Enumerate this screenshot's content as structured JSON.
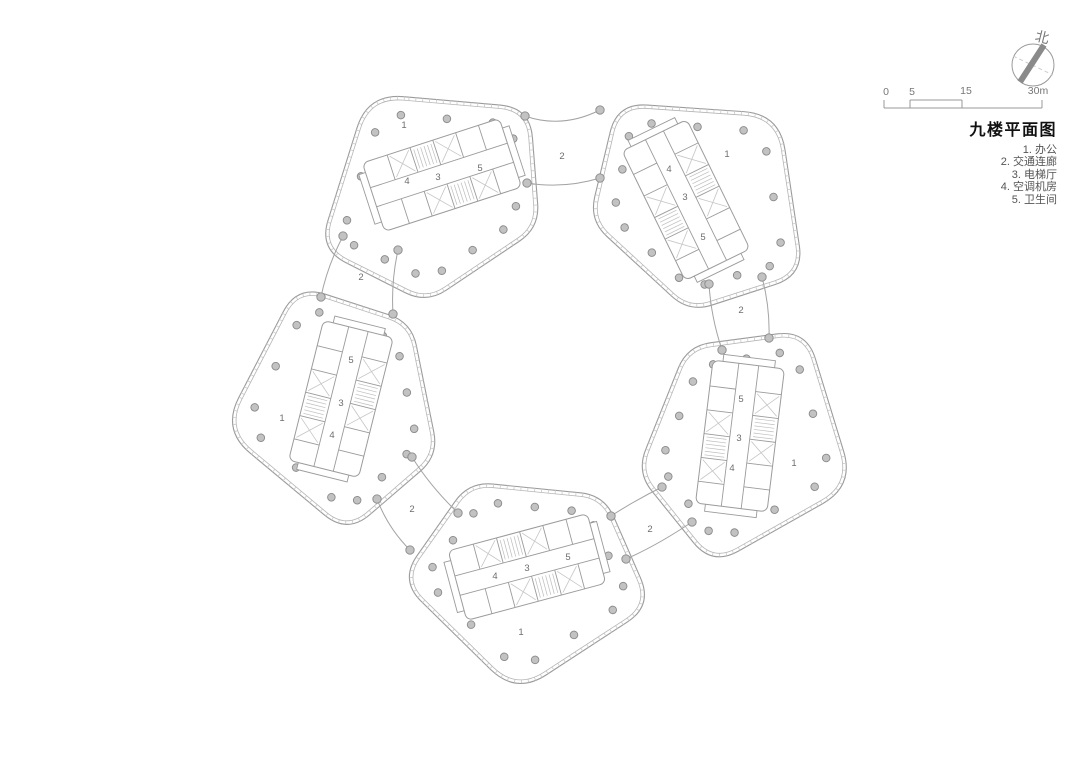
{
  "title_block": {
    "title": "九楼平面图",
    "legend": [
      "1. 办公",
      "2. 交通连廊",
      "3. 电梯厅",
      "4. 空调机房",
      "5. 卫生间"
    ]
  },
  "north_indicator": {
    "label": "北"
  },
  "scale_bar": {
    "ticks": [
      "0",
      "5",
      "15",
      "30m"
    ]
  },
  "plan": {
    "floor_labels": [
      {
        "t": "1",
        "x": 404,
        "y": 125
      },
      {
        "t": "1",
        "x": 727,
        "y": 154
      },
      {
        "t": "1",
        "x": 282,
        "y": 418
      },
      {
        "t": "1",
        "x": 794,
        "y": 463
      },
      {
        "t": "1",
        "x": 521,
        "y": 632
      },
      {
        "t": "2",
        "x": 562,
        "y": 156
      },
      {
        "t": "2",
        "x": 361,
        "y": 277
      },
      {
        "t": "2",
        "x": 741,
        "y": 310
      },
      {
        "t": "2",
        "x": 412,
        "y": 509
      },
      {
        "t": "2",
        "x": 650,
        "y": 529
      },
      {
        "t": "3",
        "x": 438,
        "y": 177
      },
      {
        "t": "3",
        "x": 685,
        "y": 197
      },
      {
        "t": "3",
        "x": 341,
        "y": 403
      },
      {
        "t": "3",
        "x": 739,
        "y": 438
      },
      {
        "t": "3",
        "x": 527,
        "y": 568
      },
      {
        "t": "4",
        "x": 407,
        "y": 181
      },
      {
        "t": "4",
        "x": 669,
        "y": 169
      },
      {
        "t": "4",
        "x": 332,
        "y": 435
      },
      {
        "t": "4",
        "x": 732,
        "y": 468
      },
      {
        "t": "4",
        "x": 495,
        "y": 576
      },
      {
        "t": "5",
        "x": 480,
        "y": 168
      },
      {
        "t": "5",
        "x": 703,
        "y": 237
      },
      {
        "t": "5",
        "x": 351,
        "y": 360
      },
      {
        "t": "5",
        "x": 741,
        "y": 399
      },
      {
        "t": "5",
        "x": 568,
        "y": 557
      }
    ]
  },
  "colors": {
    "wall": "#9b9b9b",
    "wall_light": "#b5b5b5",
    "tick": "#cacaca",
    "hatch": "#c6c6c6",
    "stair": "#bcbcbc",
    "column_fill": "#c2c2c2",
    "column_stroke": "#8a8a8a",
    "corridor_wall": "#a3a3a3",
    "room_label": "#6e6e6e",
    "scale_line": "#999999",
    "scale_text": "#777777",
    "north_needle": "#8a8a8a",
    "north_cross": "#cccccc",
    "north_text": "#777777"
  }
}
